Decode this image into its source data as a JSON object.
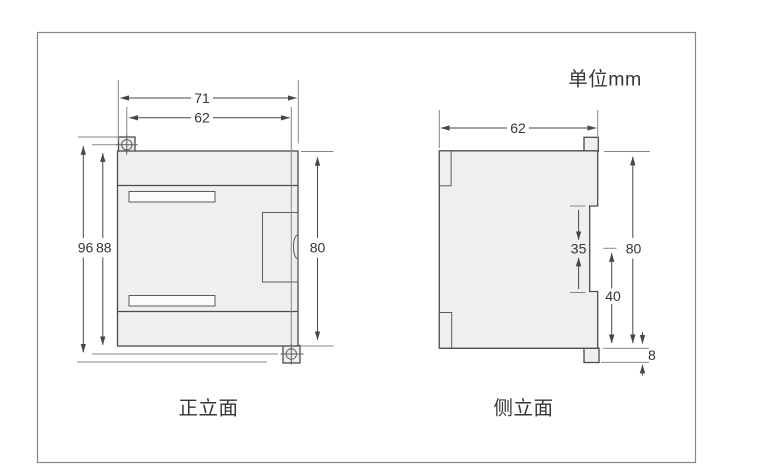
{
  "unit_label": "单位mm",
  "front_view": {
    "caption": "正立面",
    "dims": {
      "overall_width": "71",
      "mounting_width": "62",
      "overall_height": "96",
      "body_height": "88",
      "right_height": "80"
    }
  },
  "side_view": {
    "caption": "侧立面",
    "dims": {
      "depth": "62",
      "rail_notch": "35",
      "height": "80",
      "lower_section": "40",
      "clip_height": "8"
    }
  },
  "colors": {
    "frame_border": "#858585",
    "outline": "#4c4c50",
    "thin_line": "#5c5c60",
    "ext_line": "#87878b",
    "dim_line": "#47474b",
    "body_fill": "#eeeff1",
    "slot_fill": "#fbfbfc",
    "text": "#353539",
    "background": "#ffffff"
  }
}
